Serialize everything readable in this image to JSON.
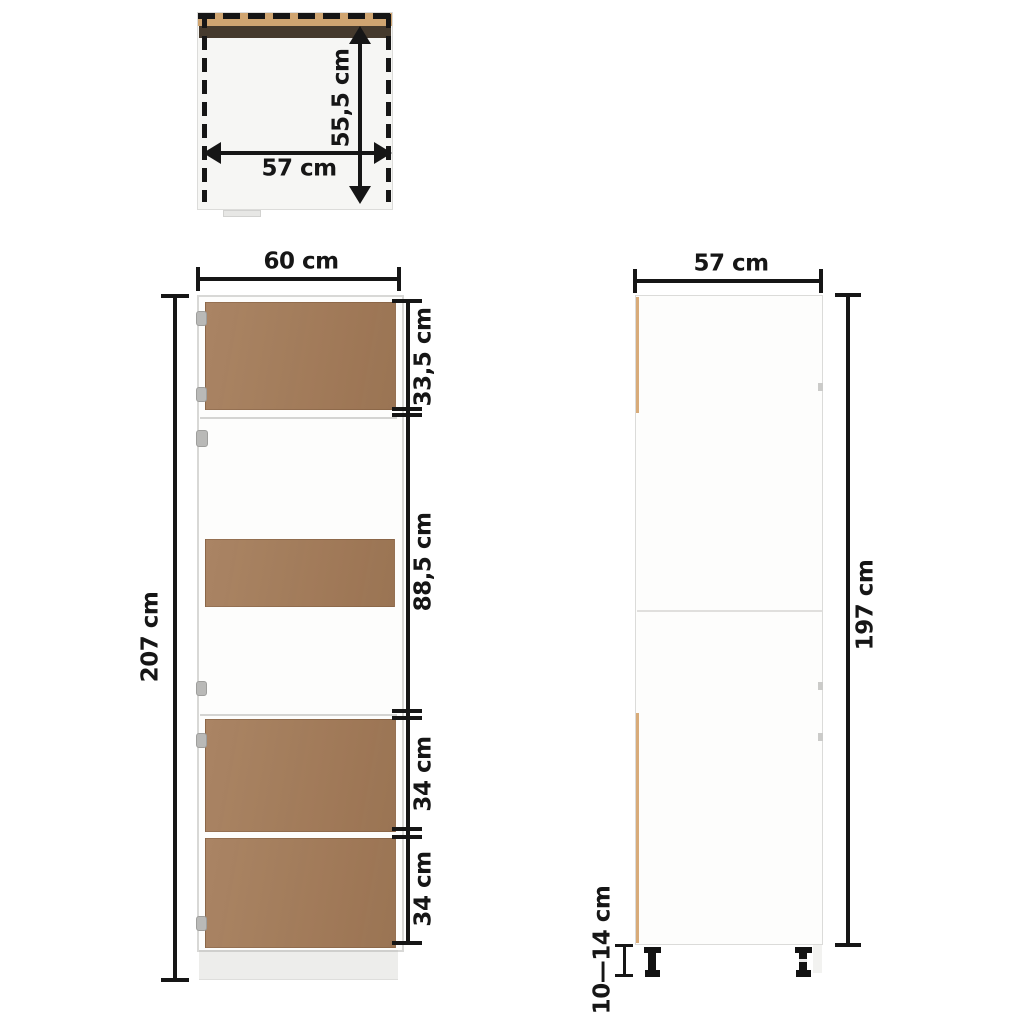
{
  "colors": {
    "background": "#ffffff",
    "door_brown": "#a47b58",
    "top_tan": "#d0a571",
    "top_dark_brown": "#453a2d",
    "edge_tan": "#d8ab79",
    "dimension_black": "#161616",
    "body_white": "#fdfdfc",
    "outline_gray": "#d8d8d6",
    "plinth_gray": "#ededeb",
    "foot_black": "#121212"
  },
  "views": {
    "top_view": {
      "width_label": "57 cm",
      "depth_label": "55,5 cm"
    },
    "front_view": {
      "width_label": "60 cm",
      "height_label": "207 cm",
      "sections": [
        "33,5 cm",
        "88,5 cm",
        "34 cm",
        "34 cm"
      ]
    },
    "side_view": {
      "width_label": "57 cm",
      "height_label": "197 cm",
      "feet_label": "10—14 cm"
    }
  }
}
